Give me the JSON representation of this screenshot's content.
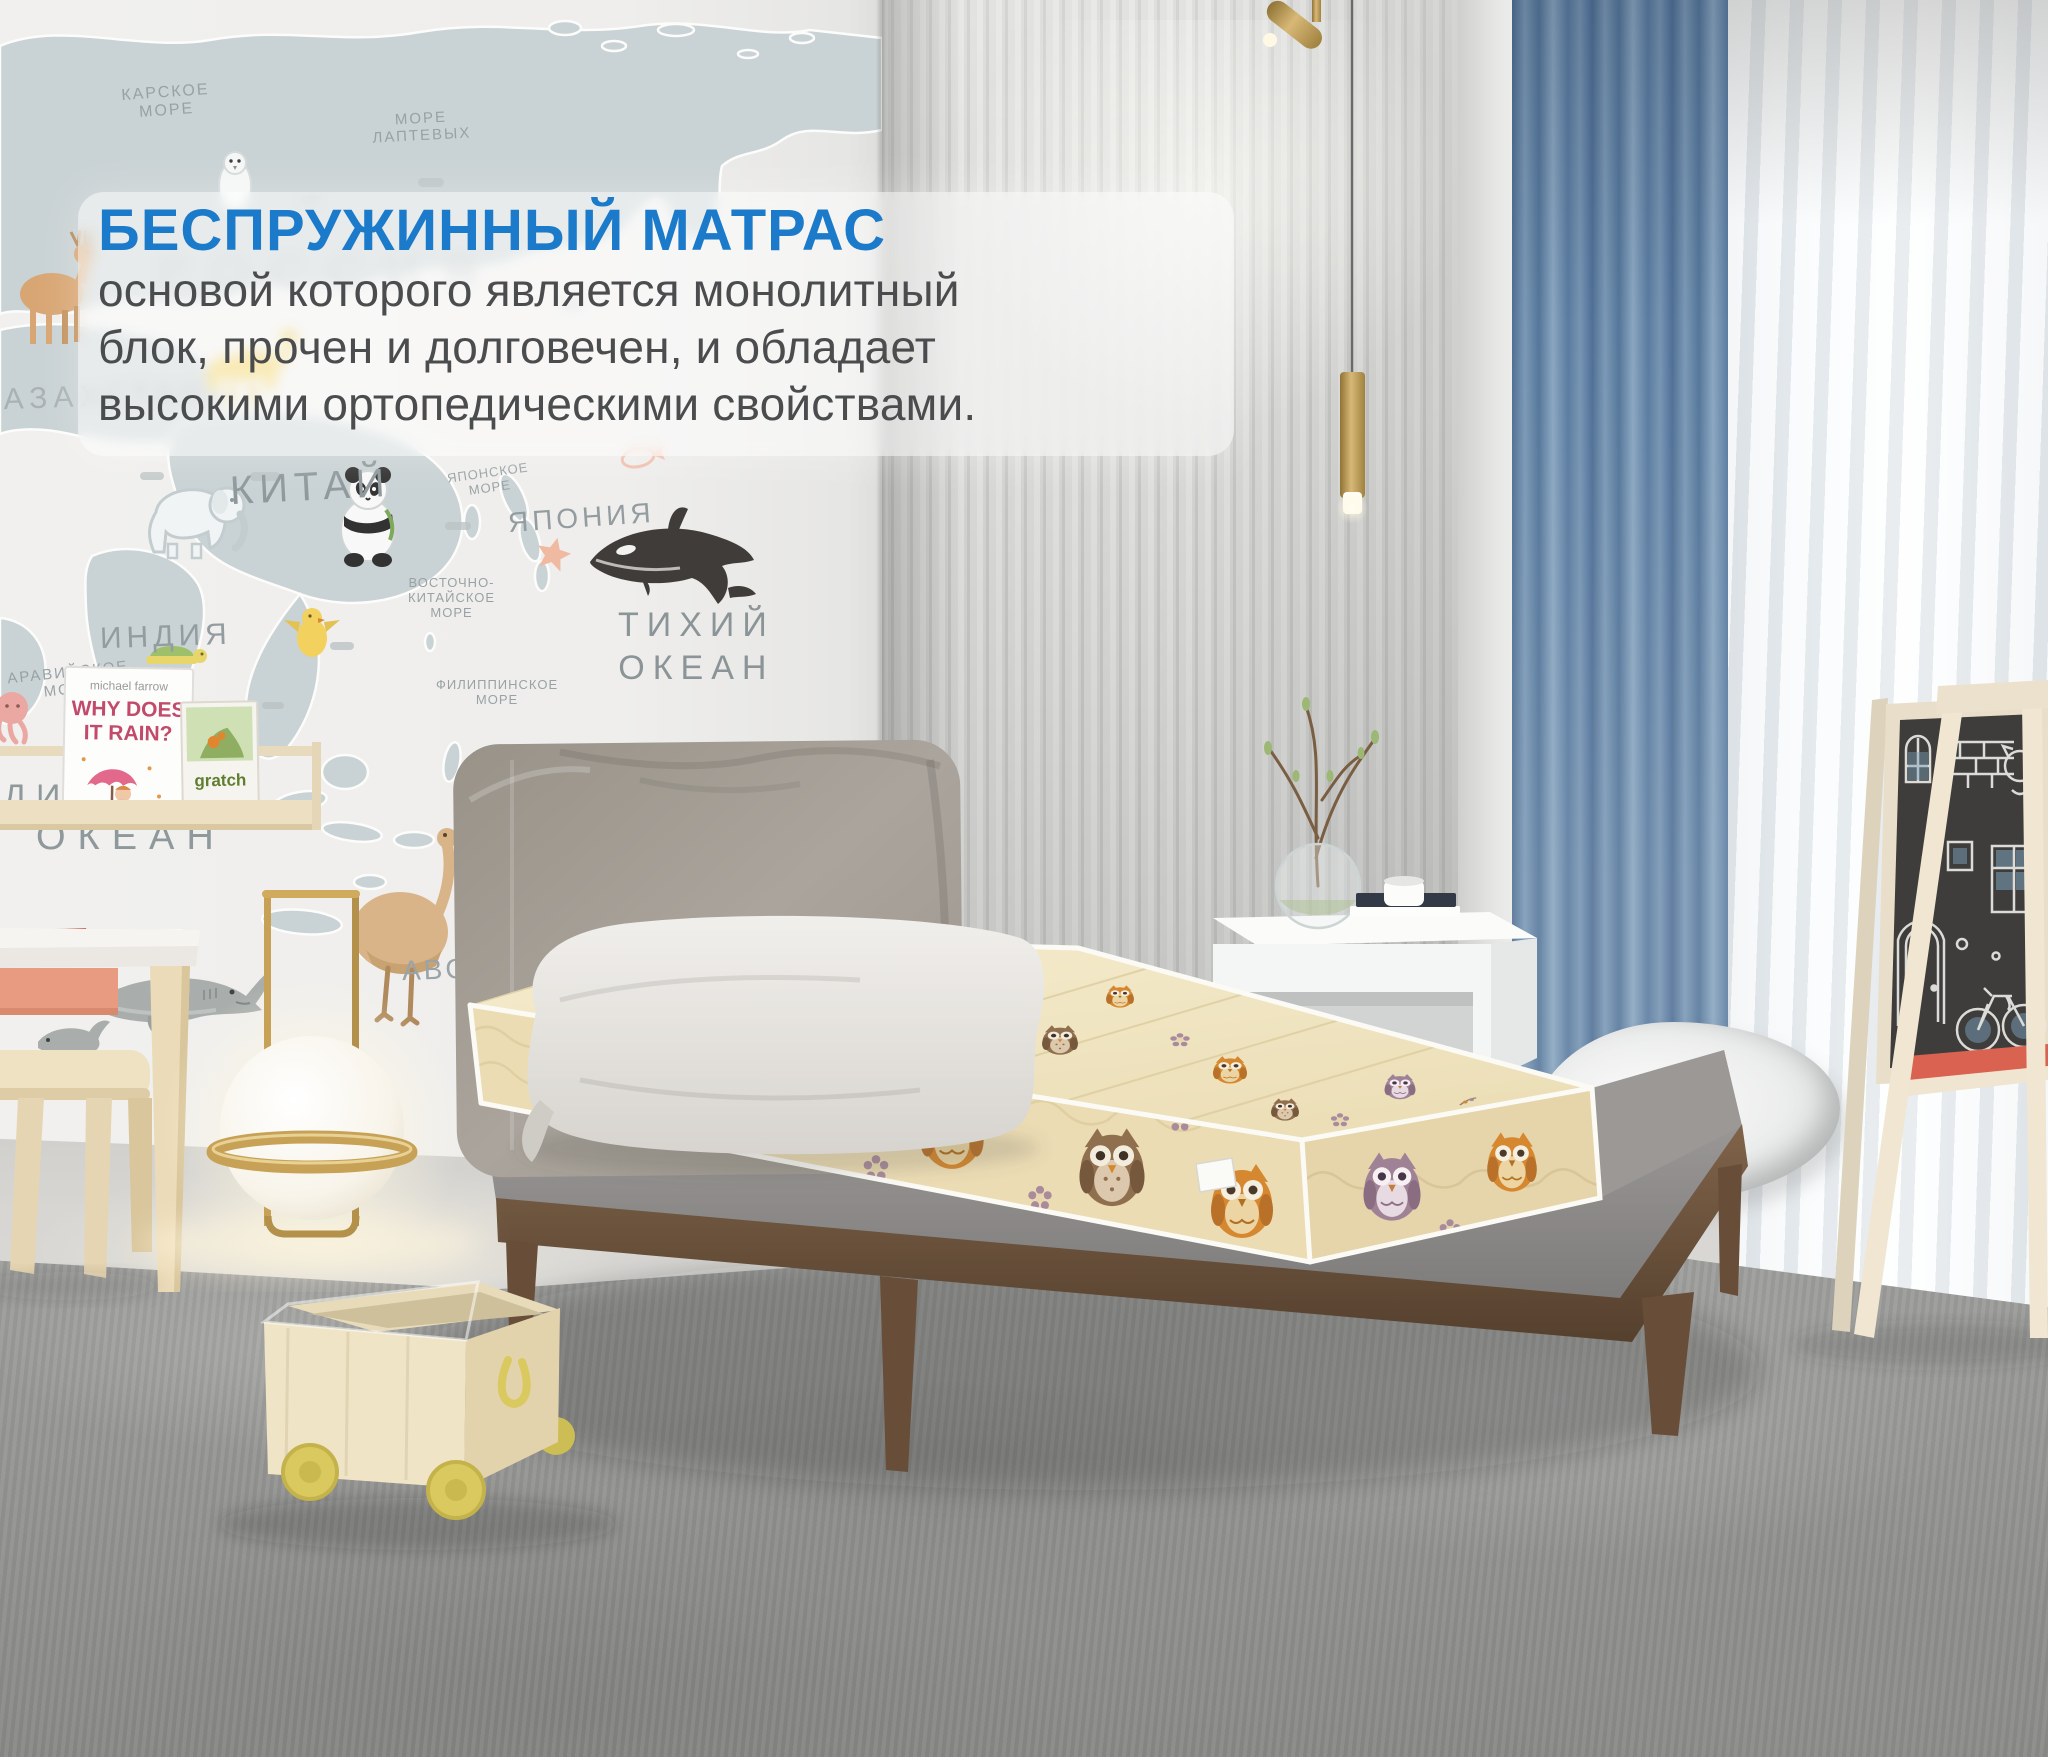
{
  "overlay": {
    "title": "БЕСПРУЖИННЫЙ МАТРАС",
    "line1": "основой которого является монолитный",
    "line2": "блок, прочен и долговечен, и обладает",
    "line3": "высокими ортопедическими свойствами."
  },
  "map": {
    "labels": {
      "russia": "РОССИЯ",
      "kara_sea": "КАРСКОЕ\nМОРЕ",
      "laptev_sea": "МОРЕ\nЛАПТЕВЫХ",
      "kazakhstan": "КАЗАХСТАН",
      "china": "КИТАЙ",
      "india": "ИНДИЯ",
      "japan": "ЯПОНИЯ",
      "japan_sea": "ЯПОНСКОЕ\nМОРЕ",
      "east_china_sea": "ВОСТОЧНО-\nКИТАЙСКОЕ\nМОРЕ",
      "philippine_sea": "ФИЛИППИНСКОЕ\nМОРЕ",
      "arabian_sea": "АРАВИЙСКОЕ\nМОРЕ",
      "pacific_ocean": "ТИХИЙ\nОКЕАН",
      "indian_ocean_partial": "ИНДИЙСКИЙ",
      "ocean": "ОКЕАН",
      "abc": "ABC"
    }
  },
  "shelf": {
    "book1_author": "michael farrow",
    "book1_title_line1": "WHY DOES",
    "book1_title_line2": "IT RAIN?",
    "book2_title": "gratch"
  },
  "colors": {
    "accent_blue": "#1b7ac9",
    "body_text": "#4a4c4e",
    "curtain_blue": "#6f8fae",
    "mattress_cream": "#f0e5c2",
    "owl_orange": "#d5882f",
    "wood_walnut": "#6e5440",
    "wheel_yellow": "#d9c95f",
    "brass": "#c7a256",
    "headboard_gray": "#a8a29b",
    "rug_gray": "#9a9a98"
  }
}
